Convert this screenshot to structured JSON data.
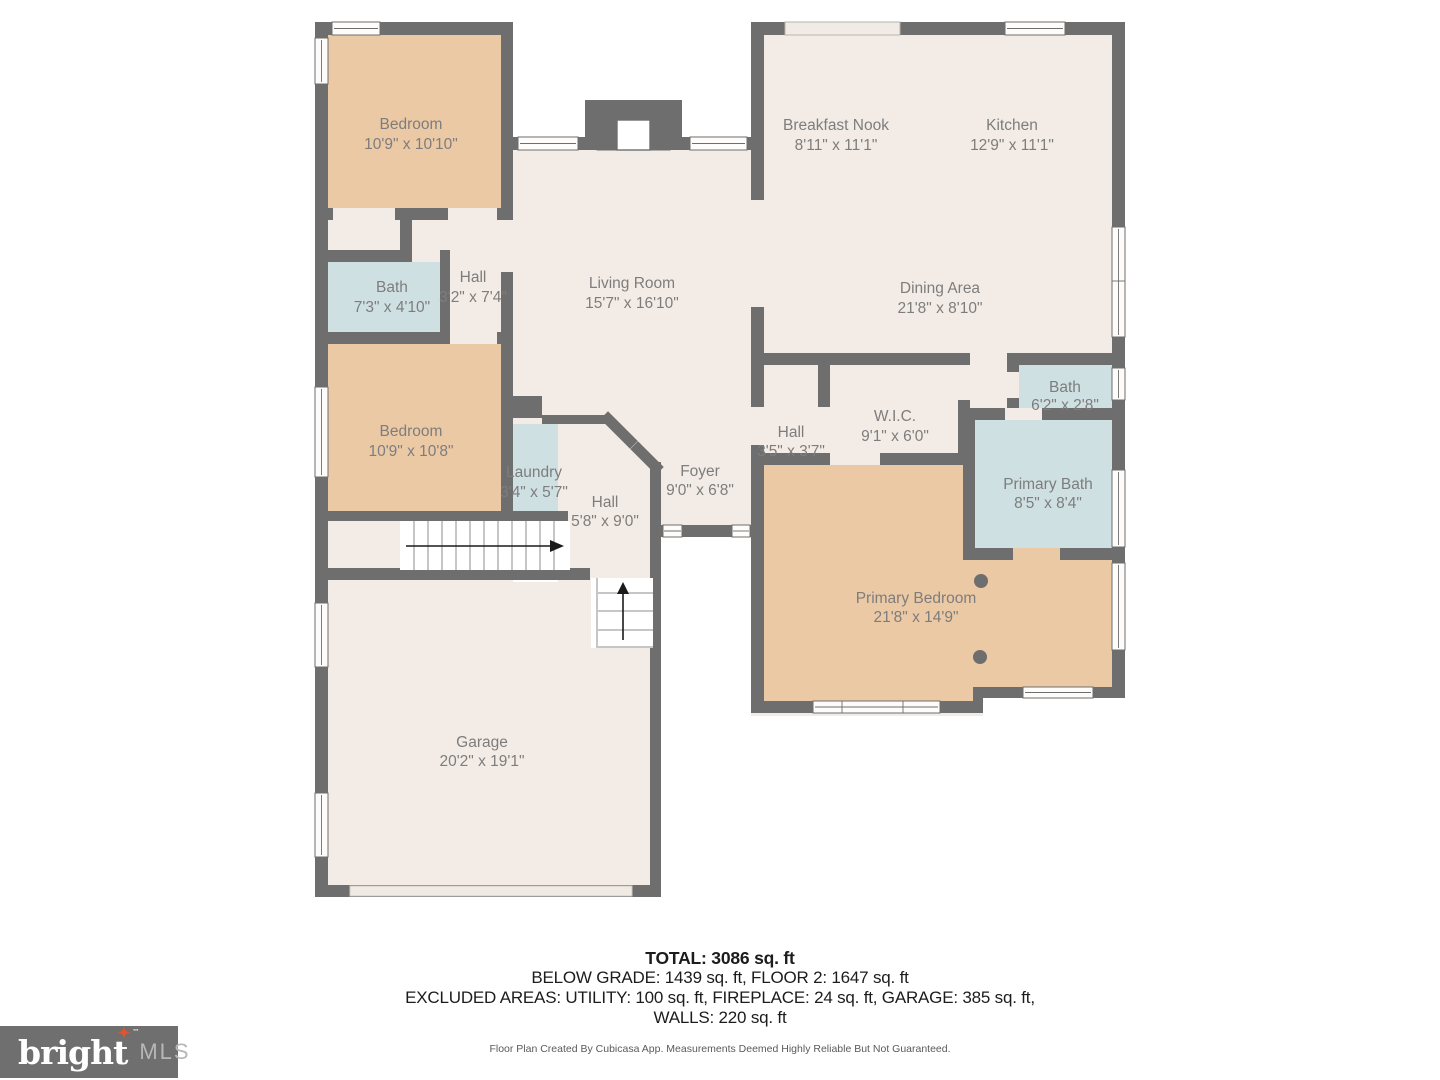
{
  "rooms": [
    {
      "name": "Bedroom",
      "dims": "10'9\" x 10'10\""
    },
    {
      "name": "Bath",
      "dims": "7'3\" x 4'10\""
    },
    {
      "name": "Hall",
      "dims": "3'2\" x 7'4\""
    },
    {
      "name": "Living Room",
      "dims": "15'7\" x 16'10\""
    },
    {
      "name": "Breakfast Nook",
      "dims": "8'11\" x 11'1\""
    },
    {
      "name": "Kitchen",
      "dims": "12'9\" x 11'1\""
    },
    {
      "name": "Dining Area",
      "dims": "21'8\" x 8'10\""
    },
    {
      "name": "Bedroom",
      "dims": "10'9\" x 10'8\""
    },
    {
      "name": "Laundry",
      "dims": "3'4\" x 5'7\""
    },
    {
      "name": "Hall",
      "dims": "5'8\" x 9'0\""
    },
    {
      "name": "Foyer",
      "dims": "9'0\" x 6'8\""
    },
    {
      "name": "Hall",
      "dims": "3'5\" x 3'7\""
    },
    {
      "name": "W.I.C.",
      "dims": "9'1\" x 6'0\""
    },
    {
      "name": "Bath",
      "dims": "6'2\" x 2'8\""
    },
    {
      "name": "Primary Bath",
      "dims": "8'5\" x 8'4\""
    },
    {
      "name": "Primary Bedroom",
      "dims": "21'8\" x 14'9\""
    },
    {
      "name": "Garage",
      "dims": "20'2\" x 19'1\""
    }
  ],
  "summary": {
    "total": "TOTAL: 3086 sq. ft",
    "below_grade_line": "BELOW GRADE: 1439 sq. ft, FLOOR 2: 1647 sq. ft",
    "excluded_line": "EXCLUDED AREAS: UTILITY: 100 sq. ft, FIREPLACE: 24 sq. ft, GARAGE: 385 sq. ft,",
    "walls_line": "WALLS: 220 sq. ft"
  },
  "disclaimer": "Floor Plan Created By Cubicasa App. Measurements Deemed Highly Reliable But Not Guaranteed.",
  "logo": {
    "brand": "bright",
    "suffix": "MLS",
    "tm": "™",
    "star": "✦"
  },
  "colors": {
    "wall": "#6e6e6e",
    "floor": "#f3ece6",
    "bedroom_floor": "#ecc9a5",
    "wet_room_floor": "#cfe0e2",
    "logo_accent": "#e8522a"
  }
}
